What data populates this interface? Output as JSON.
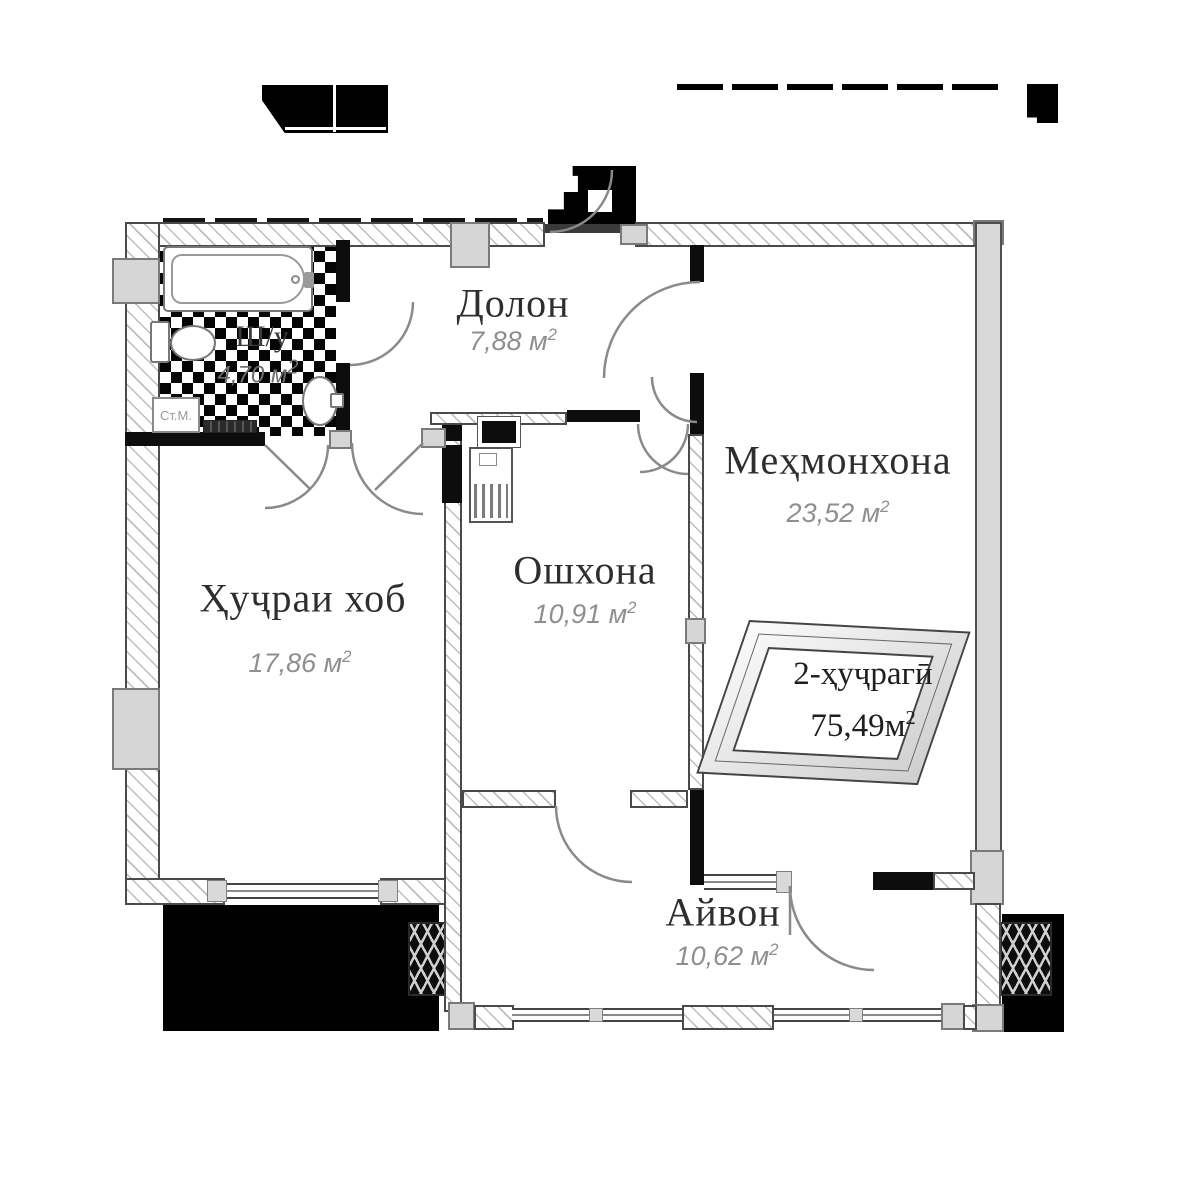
{
  "plan_title": "apartment-floor-plan",
  "rooms": [
    {
      "name": "Долон",
      "area": "7,88 м",
      "sup": "2"
    },
    {
      "name": "Меҳмонхона",
      "area": "23,52 м",
      "sup": "2"
    },
    {
      "name": "Ошхона",
      "area": "10,91 м",
      "sup": "2"
    },
    {
      "name": "Ҳуҷраи хоб",
      "area": "17,86 м",
      "sup": "2"
    },
    {
      "name": "Айвон",
      "area": "10,62 м",
      "sup": "2"
    },
    {
      "name": "Ш/у",
      "area": "4,70 м",
      "sup": "2"
    }
  ],
  "badge": {
    "line1": "2-ҳуҷрагӣ",
    "line2": "75,49м",
    "sup": "2"
  },
  "labels": {
    "washing_machine": "Ст.М."
  },
  "colors": {
    "wall_black": "#0d0d0d",
    "pillar_gray": "#d6d6d6",
    "room_text": "#2e2e2e",
    "area_text": "#8f8f8f"
  }
}
